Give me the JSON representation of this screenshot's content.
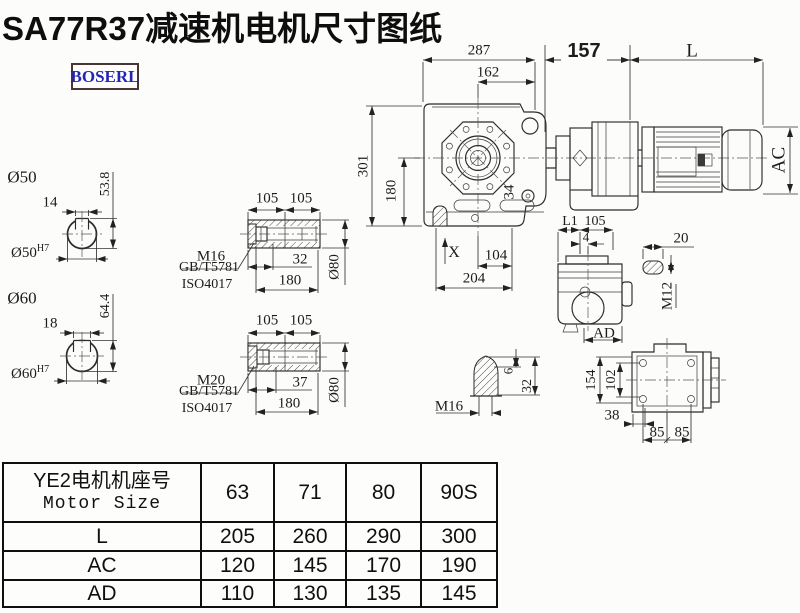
{
  "title": "SA77R37减速机电机尺寸图纸",
  "logo": "BOSERL",
  "front_view": {
    "dim_287": "287",
    "dim_162": "162",
    "dim_157": "157",
    "dim_L": "L",
    "dim_AC": "AC",
    "dim_301": "301",
    "dim_180": "180",
    "dim_34": "34",
    "dim_X": "X",
    "dim_104": "104",
    "dim_204": "204"
  },
  "shaft_hole_50": {
    "label": "Ø50",
    "keyway_width": "14",
    "keyway_height": "53.8",
    "bore": "Ø50",
    "tolerance": "H7"
  },
  "shaft_hole_60": {
    "label": "Ø60",
    "keyway_width": "18",
    "keyway_height": "64.4",
    "bore": "Ø60",
    "tolerance": "H7"
  },
  "hollow_shaft_a": {
    "dim_105_left": "105",
    "dim_105_right": "105",
    "bolt": "M16",
    "standard_1": "GB/T5781",
    "standard_2": "ISO4017",
    "dim_32": "32",
    "dim_180": "180",
    "dim_dia": "Ø80"
  },
  "hollow_shaft_b": {
    "dim_105_left": "105",
    "dim_105_right": "105",
    "bolt": "M20",
    "standard_1": "GB/T5781",
    "standard_2": "ISO4017",
    "dim_37": "37",
    "dim_180": "180",
    "dim_dia": "Ø80"
  },
  "side_view": {
    "dim_L1": "L1",
    "dim_105": "105",
    "dim_4": "4",
    "dim_AD": "AD"
  },
  "key_detail": {
    "dim_20": "20",
    "thread": "M12"
  },
  "plug_detail": {
    "thread": "M16",
    "dim_6": "6",
    "dim_32": "32"
  },
  "rear_view": {
    "dim_154": "154",
    "dim_102": "102",
    "dim_38": "38",
    "dim_85_left": "85",
    "dim_85_right": "85"
  },
  "size_table": {
    "header_cn": "YE2电机机座号",
    "header_en": "Motor Size",
    "columns": [
      "63",
      "71",
      "80",
      "90S"
    ],
    "rows": [
      {
        "label": "L",
        "values": [
          "205",
          "260",
          "290",
          "300"
        ]
      },
      {
        "label": "AC",
        "values": [
          "120",
          "145",
          "170",
          "190"
        ]
      },
      {
        "label": "AD",
        "values": [
          "110",
          "130",
          "135",
          "145"
        ]
      }
    ]
  }
}
